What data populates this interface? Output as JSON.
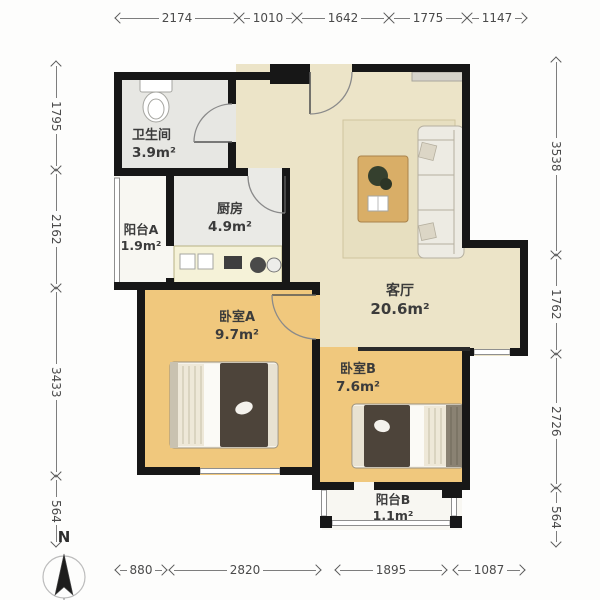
{
  "compass": {
    "label": "N"
  },
  "rooms": {
    "bathroom": {
      "name": "卫生间",
      "area": "3.9m²"
    },
    "balcony_a": {
      "name": "阳台A",
      "area": "1.9m²"
    },
    "kitchen": {
      "name": "厨房",
      "area": "4.9m²"
    },
    "living": {
      "name": "客厅",
      "area": "20.6m²"
    },
    "bedroom_a": {
      "name": "卧室A",
      "area": "9.7m²"
    },
    "bedroom_b": {
      "name": "卧室B",
      "area": "7.6m²"
    },
    "balcony_b": {
      "name": "阳台B",
      "area": "1.1m²"
    }
  },
  "dims": {
    "top": [
      "2174",
      "1010",
      "1642",
      "1775",
      "1147"
    ],
    "bottom": [
      "880",
      "2820",
      "1895",
      "1087"
    ],
    "left": [
      "1795",
      "2162",
      "3433",
      "564"
    ],
    "right": [
      "3538",
      "1762",
      "2726",
      "564"
    ]
  },
  "colors": {
    "wall": "#171717",
    "floor_living": "#ece4c8",
    "floor_bedroom": "#f0c87d",
    "floor_service": "#eaeae6",
    "floor_balcony": "#f8f7f2"
  }
}
